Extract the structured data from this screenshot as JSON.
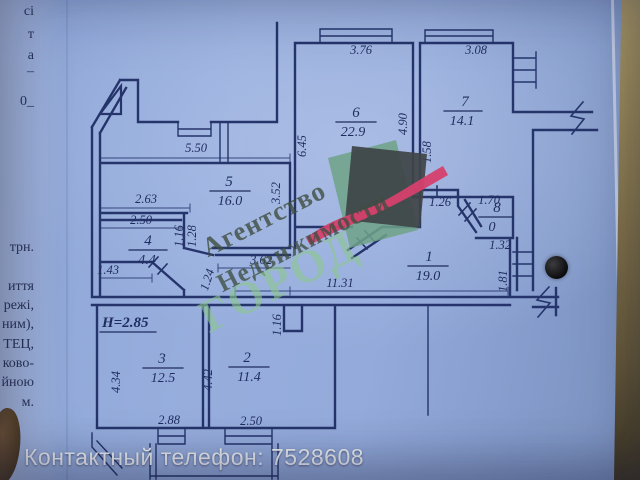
{
  "photo": {
    "caption": "Контактный телефон: 7528608"
  },
  "colors": {
    "paper": "#93aada",
    "ink": "#1f2c5e",
    "watermark_green": "#8dc790",
    "watermark_dark": "#3e4e40",
    "logo_pink": "#d6406d",
    "logo_square": "#3f4446",
    "logo_green": "#6ea287",
    "edge_tan": "#8a7a4e",
    "caption_white": "#f0f2f6"
  },
  "margin_fragments": [
    "сі",
    "т",
    "а",
    "–",
    "0_",
    "трн.",
    "иття",
    "режі,",
    "ним),",
    "ТЕЦ,",
    "ково-",
    "йною",
    "м."
  ],
  "watermark": {
    "line1": "Агентство",
    "line2": "Недвижимости",
    "line3": "ГОРОД"
  },
  "plan": {
    "height_note": "Н=2.85",
    "rooms": [
      {
        "number": "1",
        "area": "19.0"
      },
      {
        "number": "2",
        "area": "11.4"
      },
      {
        "number": "3",
        "area": "12.5"
      },
      {
        "number": "4",
        "area": "4.4"
      },
      {
        "number": "5",
        "area": "16.0"
      },
      {
        "number": "6",
        "area": "22.9"
      },
      {
        "number": "7",
        "area": "14.1"
      },
      {
        "number": "8",
        "area": "0"
      }
    ],
    "dims": [
      "3.76",
      "3.08",
      "6.45",
      "4.90",
      "1.58",
      "5.50",
      "3.52",
      "2.63",
      "2.50",
      "1.16",
      "1.28",
      "1.43",
      "3.62",
      "1.24",
      "11.31",
      "1.16",
      "1.26",
      "1.70",
      "1.32",
      "1.81",
      "4.34",
      "4.42",
      "2.88",
      "2.50"
    ]
  }
}
